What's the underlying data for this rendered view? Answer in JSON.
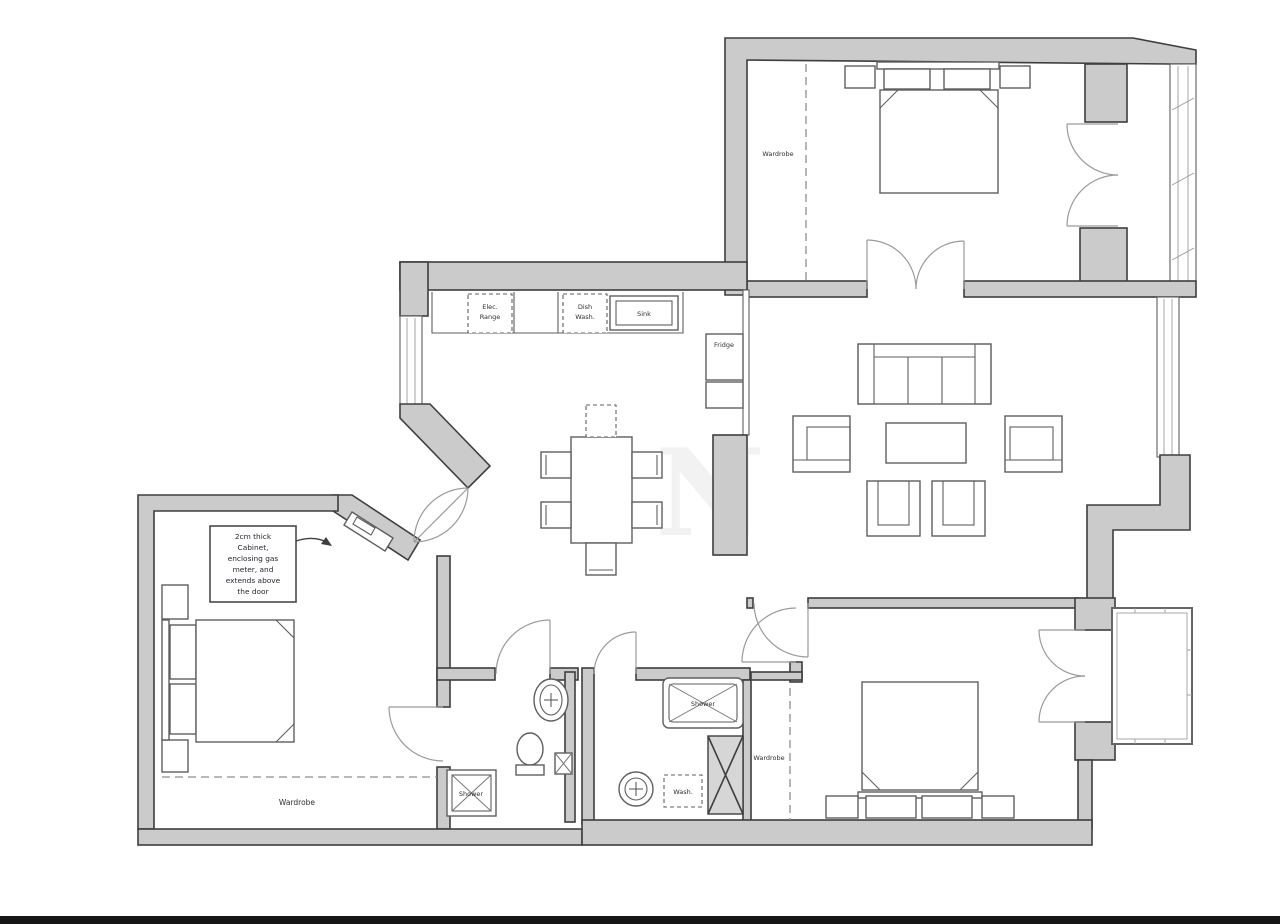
{
  "title": "Apartment floor plan",
  "colors": {
    "background": "#ffffff",
    "wall_fill": "#cbcbcb",
    "wall_stroke": "#3e3e3e",
    "furniture_stroke": "#5f5f5f",
    "light_line": "#9b9b9b",
    "dashed_line": "#8f8f8f",
    "label_color": "#2f2f2f",
    "duct_fill": "#d6d6d6",
    "bottom_bar": "#161616"
  },
  "labels": {
    "wardrobe_tr": "Wardrobe",
    "wardrobe_left": "Wardrobe",
    "wardrobe_br": "Wardrobe",
    "elec_range": [
      "Elec.",
      "Range"
    ],
    "dish_wash": [
      "Dish",
      "Wash."
    ],
    "sink": "Sink",
    "fridge": "Fridge",
    "shower_ensuite": "Shower",
    "shower_room": "Shower",
    "wash": "Wash.",
    "annotation": [
      "2cm thick",
      "Cabinet,",
      "enclosing gas",
      "meter, and",
      "extends above",
      "the door"
    ],
    "watermark": "N"
  }
}
